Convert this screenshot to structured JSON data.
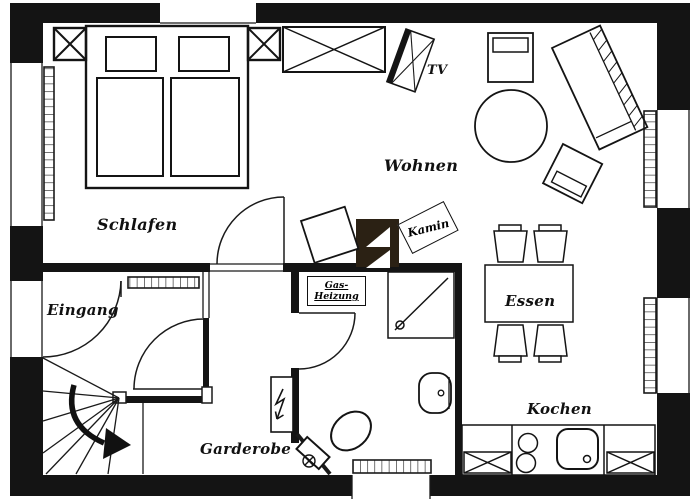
{
  "figure": {
    "type": "apartment-floor-plan",
    "width_px": 700,
    "height_px": 500
  },
  "colors": {
    "wall": "#141414",
    "line": "#1a1a1a",
    "chimney_block": "#2b2114",
    "background": "#ffffff"
  },
  "rooms": {
    "schlafen": {
      "label": "Schlafen"
    },
    "wohnen": {
      "label": "Wohnen"
    },
    "eingang": {
      "label": "Eingang"
    },
    "garderobe": {
      "label": "Garderobe"
    },
    "essen": {
      "label": "Essen"
    },
    "kochen": {
      "label": "Kochen"
    }
  },
  "annotations": {
    "tv": {
      "label": "TV"
    },
    "kamin": {
      "label": "Kamin"
    },
    "gas_heizung": {
      "line1": "Gas-",
      "line2": "Heizung"
    }
  }
}
